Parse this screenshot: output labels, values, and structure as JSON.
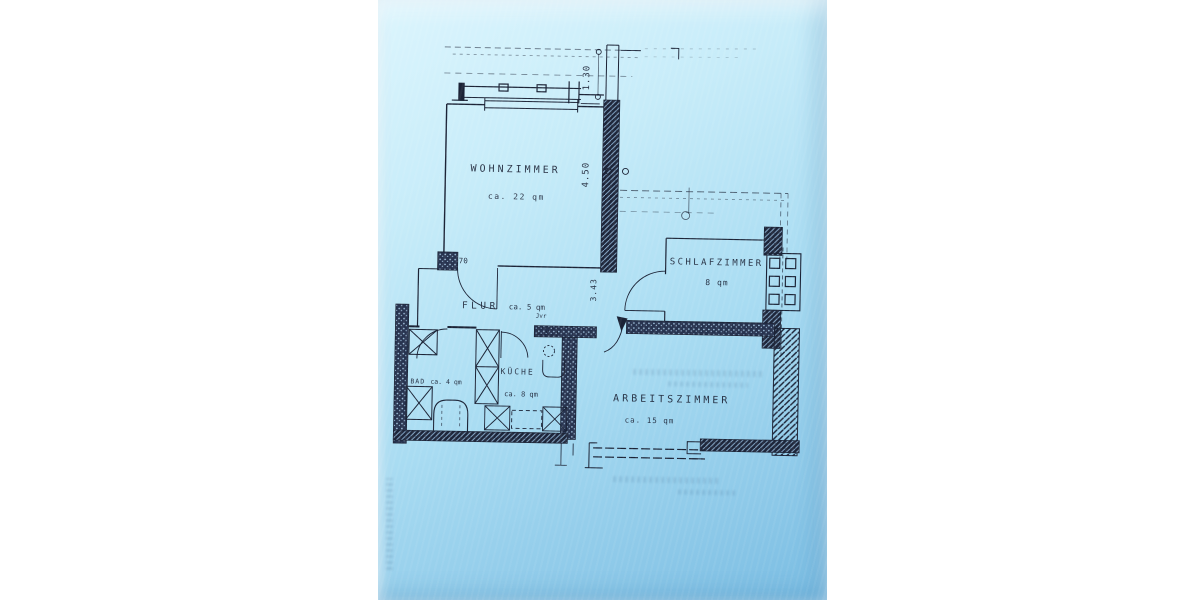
{
  "scan": {
    "paper_color_top": "#d6f2fc",
    "paper_color_bottom": "#79bce2",
    "ink_color": "#1b2336"
  },
  "floor_plan": {
    "rooms": [
      {
        "id": "wohnzimmer",
        "name": "WOHNZIMMER",
        "area": "ca. 22 qm"
      },
      {
        "id": "schlafzimmer",
        "name": "SCHLAFZIMMER",
        "area": "8 qm"
      },
      {
        "id": "flur",
        "name": "FLUR",
        "area": "ca. 5 qm"
      },
      {
        "id": "bad",
        "name": "BAD",
        "area": "ca. 4 qm"
      },
      {
        "id": "kueche",
        "name": "KÜCHE",
        "area": "ca. 8 qm"
      },
      {
        "id": "arbeitszimmer",
        "name": "ARBEITSZIMMER",
        "area": "ca. 15 qm"
      }
    ],
    "dimensions": [
      {
        "id": "balcony-depth",
        "label": "1.30"
      },
      {
        "id": "living-room-width",
        "label": "4.50"
      },
      {
        "id": "door-width",
        "label": "70"
      },
      {
        "id": "hall-depth",
        "label": "3.43"
      },
      {
        "id": "hall-note",
        "label": "Jvr"
      }
    ]
  }
}
